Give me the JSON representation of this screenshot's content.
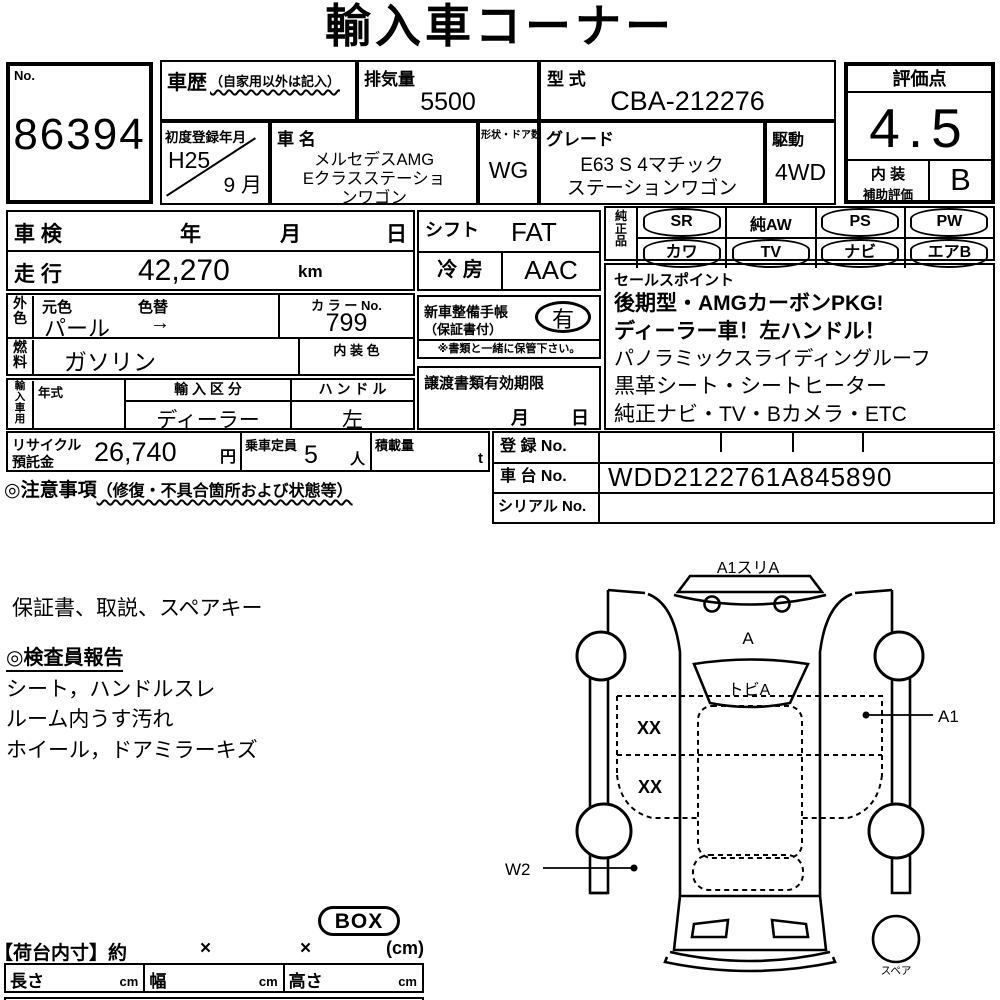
{
  "title": "輸入車コーナー",
  "no_box": {
    "label": "No.",
    "value": "86394"
  },
  "top": {
    "history_label": "車歴",
    "history_note": "（自家用以外は記入）",
    "displacement_label": "排気量",
    "displacement_value": "5500",
    "model_code_label": "型 式",
    "model_code_value": "CBA-212276",
    "first_reg_label": "初度登録年月",
    "first_reg_year": "H25",
    "first_reg_month": "9 月",
    "car_name_label": "車  名",
    "car_name_lines": [
      "メルセデスAMG",
      "Eクラスステーショ",
      "ンワゴン"
    ],
    "shape_label": "形状・ドア数",
    "shape_value": "WG",
    "grade_label": "グレード",
    "grade_lines": [
      "E63  S  4マチック",
      "ステーションワゴン"
    ],
    "drive_label": "駆動",
    "drive_value": "4WD"
  },
  "score": {
    "label": "評価点",
    "value": "4.5",
    "interior_label_1": "内 装",
    "interior_label_2": "補助評価",
    "interior_value": "B"
  },
  "left_block": {
    "shaken_label": "車 検",
    "shaken_year": "年",
    "shaken_month": "月",
    "shaken_day": "日",
    "mileage_label": "走 行",
    "mileage_value": "42,270",
    "mileage_unit": "km",
    "ext_color_label": "外\n色",
    "orig_color_label": "元色",
    "color_change_label": "色替",
    "color_value": "パール",
    "color_arrow": "→",
    "color_no_label": "カ ラ ー No.",
    "color_no_value": "799",
    "fuel_label": "燃\n料",
    "fuel_value": "ガソリン",
    "int_color_label": "内 装 色",
    "import_label": "輸\n入\n車\n用",
    "year_type_label": "年式",
    "import_class_label": "輸 入 区 分",
    "import_class_value": "ディーラー",
    "handle_label": "ハ ン ド ル",
    "handle_value": "左"
  },
  "center_block": {
    "shift_label": "シフト",
    "shift_value": "FAT",
    "ac_label": "冷  房",
    "ac_value": "AAC",
    "record_book_label_1": "新車整備手帳",
    "record_book_label_2": "（保証書付）",
    "record_book_value": "有",
    "record_book_note": "※書類と一緒に保管下さい。",
    "transfer_label": "譲渡書類有効期限",
    "transfer_month": "月",
    "transfer_day": "日"
  },
  "equipment": {
    "label": "純\n正\n品",
    "items": [
      {
        "label": "SR",
        "circled": true
      },
      {
        "label": "純AW",
        "circled": false
      },
      {
        "label": "PS",
        "circled": true
      },
      {
        "label": "PW",
        "circled": true
      },
      {
        "label": "カワ",
        "circled": true
      },
      {
        "label": "TV",
        "circled": true
      },
      {
        "label": "ナビ",
        "circled": true
      },
      {
        "label": "エアB",
        "circled": true
      }
    ]
  },
  "sales_points": {
    "label": "セールスポイント",
    "lines": [
      "後期型・AMGカーボンPKG!",
      "ディーラー車！左ハンドル！",
      "パノラミックスライディングルーフ",
      "黒革シート・シートヒーター",
      "純正ナビ・TV・Bカメラ・ETC"
    ]
  },
  "bottom_row": {
    "recycle_label_1": "リサイクル",
    "recycle_label_2": "預託金",
    "recycle_value": "26,740",
    "recycle_unit": "円",
    "capacity_label": "乗車定員",
    "capacity_value": "5",
    "capacity_unit": "人",
    "load_label": "積載量",
    "load_unit": "t"
  },
  "caution": {
    "prefix": "◎注意事項",
    "paren": "（修復・不具合箇所および状態等）"
  },
  "registration": {
    "reg_label": "登 録 No.",
    "chassis_label": "車 台 No.",
    "chassis_value": "WDD2122761A845890",
    "serial_label": "シリアル No."
  },
  "notes": {
    "accessories": "保証書、取説、スペアキー",
    "inspector_title": "◎検査員報告",
    "lines": [
      "シート，ハンドルスレ",
      "ルーム内うす汚れ",
      "ホイール，ドアミラーキズ"
    ]
  },
  "diagram": {
    "front_label": "A1スリA",
    "hood_label": "A",
    "windshield_label": "トビA",
    "floor_label_1": "XX",
    "floor_label_2": "XX",
    "right_label": "A1",
    "left_label": "W2",
    "spare_label": "スペア"
  },
  "cargo": {
    "box_stamp": "BOX",
    "dims_label": "【荷台内寸】約",
    "times_1": "×",
    "times_2": "×",
    "unit": "(cm)",
    "cells": [
      {
        "label": "長さ",
        "unit": "cm"
      },
      {
        "label": "幅",
        "unit": "cm"
      },
      {
        "label": "高さ",
        "unit": "cm"
      }
    ]
  }
}
